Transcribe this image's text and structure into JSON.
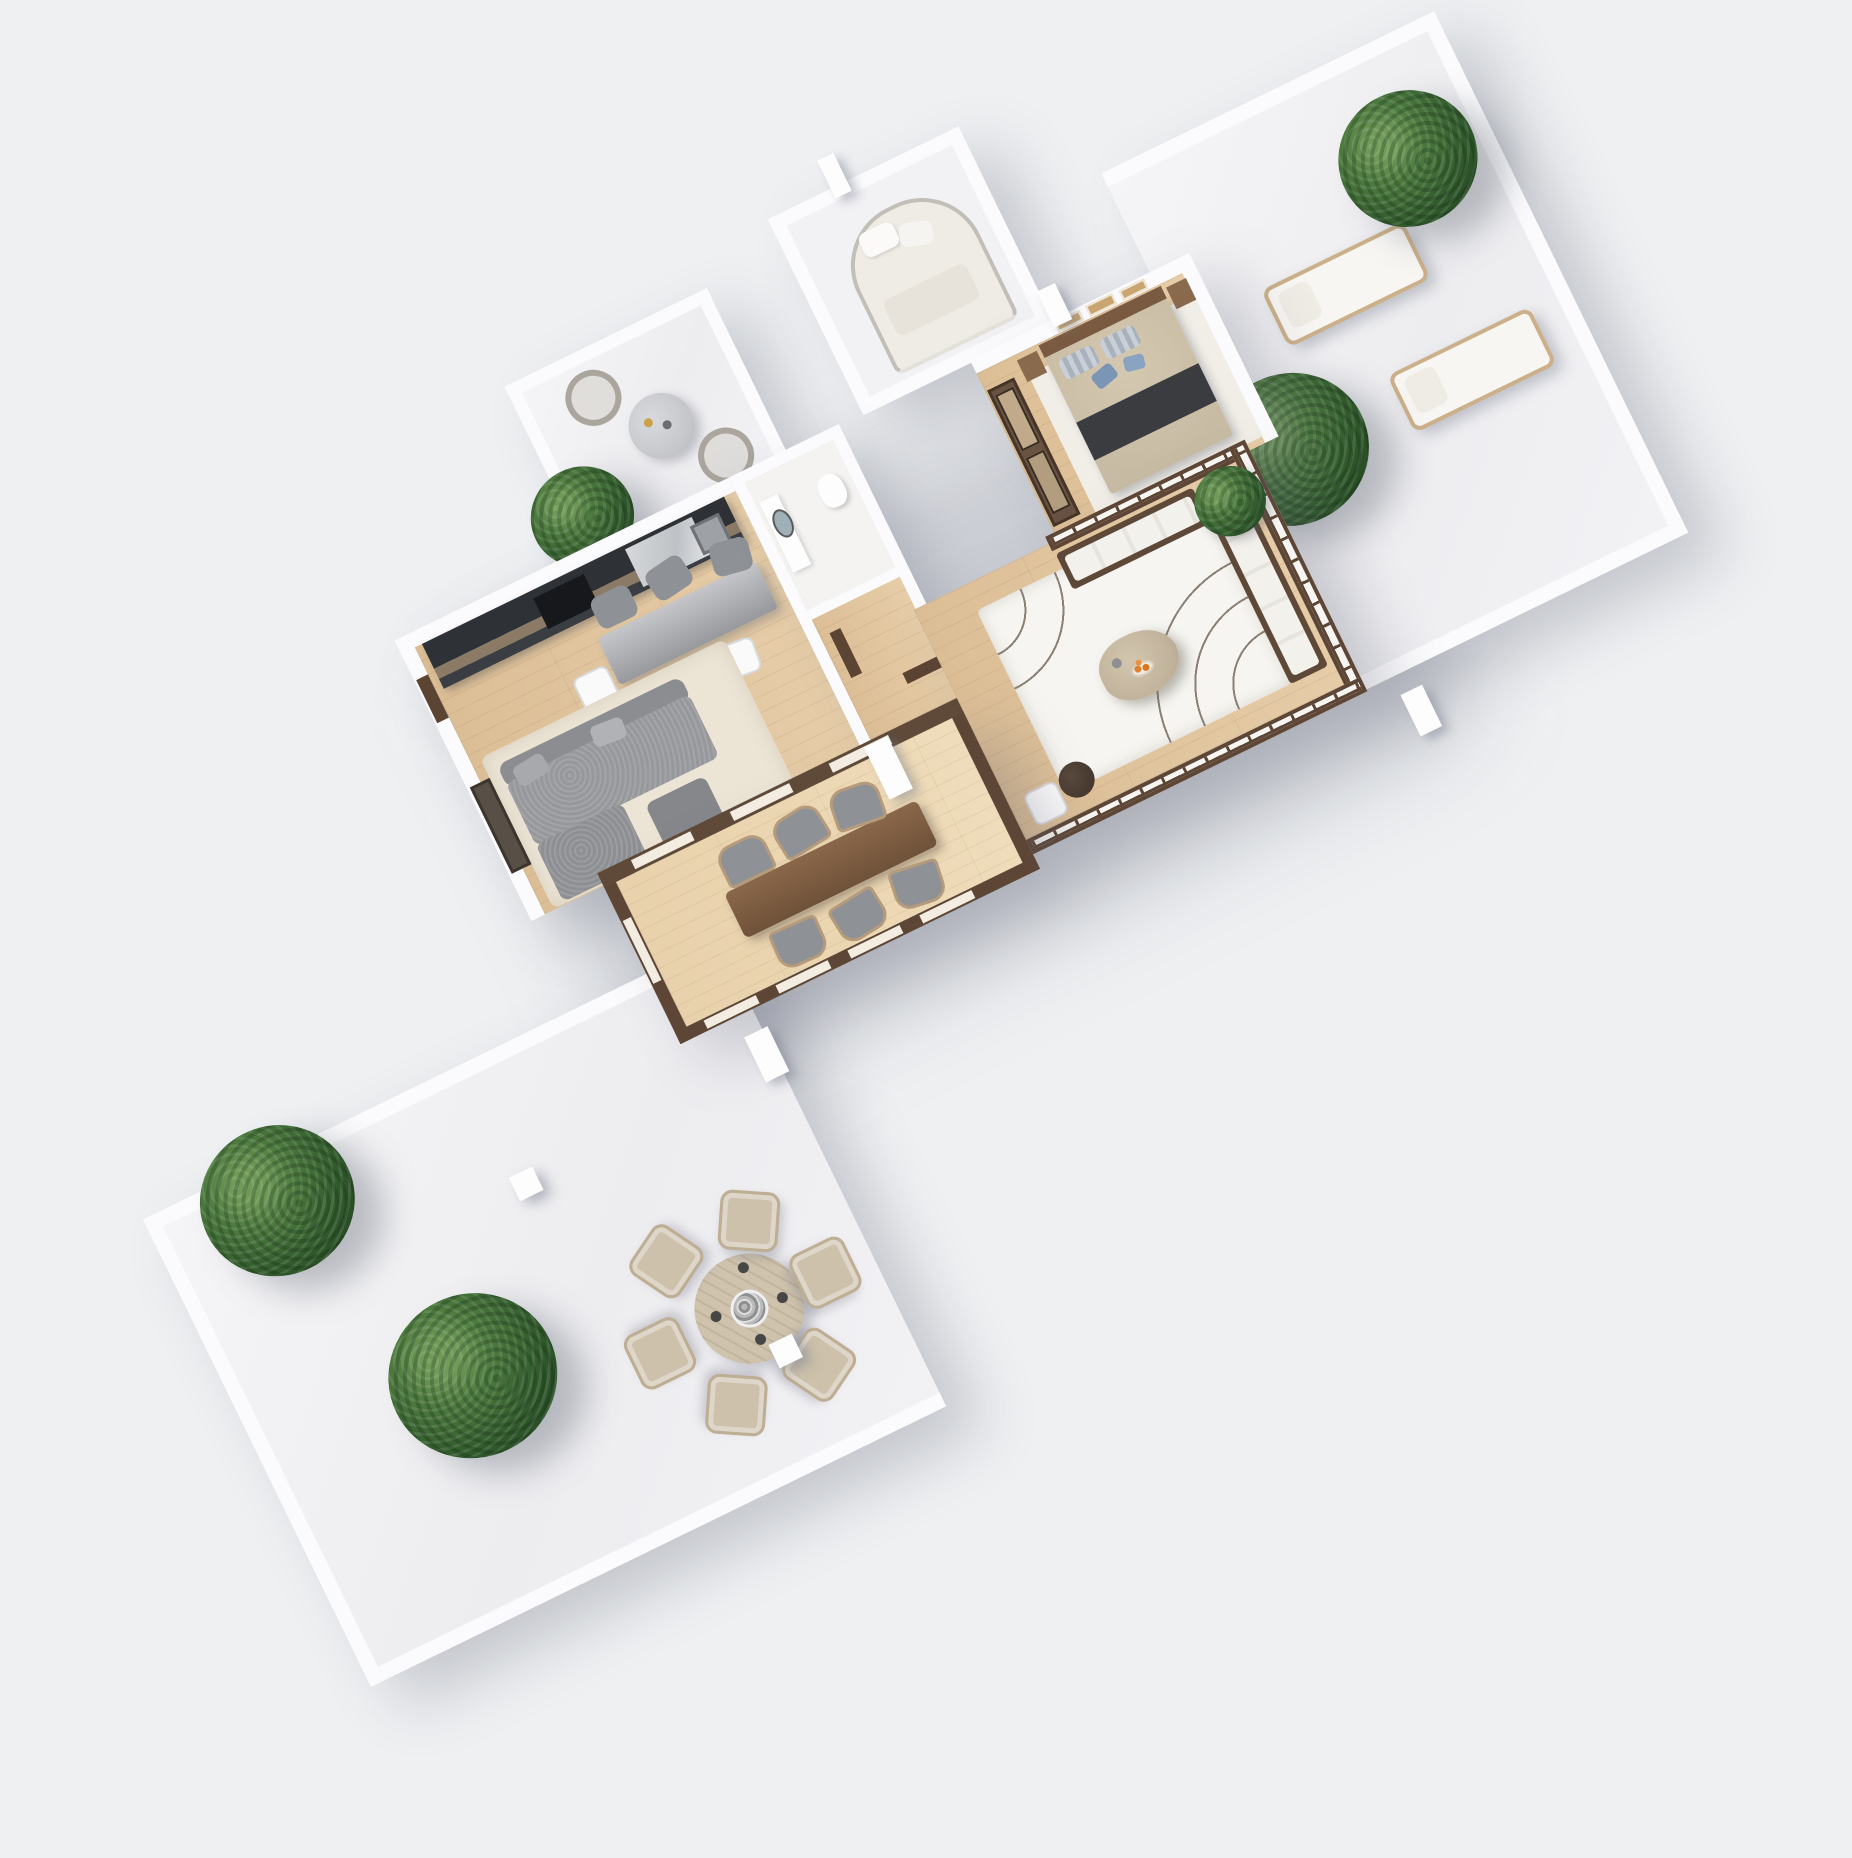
{
  "scene": {
    "type": "3d-floor-plan-render",
    "view": "axonometric top-down apartment visualization, rotated diagonally, no text labels",
    "background_color": "#eef0f2",
    "palette": {
      "bg": "#eef0f2",
      "wall": "#fbfbfd",
      "wood": "#dcbe96",
      "shoji": "#5d4636",
      "dark_wood": "#6a5243",
      "chair_gray": "#8e9195",
      "sofa_gray": "#96989c",
      "rug_cream": "#ece5d6",
      "bed_runner": "#3a3c40",
      "stone": "#c8bba3",
      "accent_orange": "#e08030",
      "leaf_hi": "#6f9a58",
      "leaf_lo": "#254a23"
    },
    "rooms": [
      {
        "name": "entry-room-top",
        "furniture": [
          "white daybed with curved headboard",
          "white walls"
        ]
      },
      {
        "name": "balcony-bistro",
        "furniture": [
          "round marble bistro table",
          "2 wire chairs",
          "potted tree"
        ]
      },
      {
        "name": "kitchen-living-dining",
        "furniture": [
          "dark kitchen counter with marble worktop",
          "steel dining table",
          "3 gray upholstered chairs",
          "3 white chairs",
          "modular gray boucle sofa",
          "cream shag rug",
          "dark media unit"
        ]
      },
      {
        "name": "bathroom",
        "furniture": [
          "vanity counter",
          "round mirror",
          "toilet"
        ]
      },
      {
        "name": "hallway",
        "furniture": [
          "dark wood doors"
        ]
      },
      {
        "name": "master-bedroom",
        "furniture": [
          "double bed with beige duvet and dark runner",
          "striped pillows",
          "blue accent pillows",
          "2 wood nightstands",
          "glass sliding-door wardrobe",
          "3 framed artworks",
          "white rug"
        ]
      },
      {
        "name": "japanese-lounge",
        "furniture": [
          "shoji screen walls",
          "wood-frame sofa with white cushions (right)",
          "wood-frame sofa with white cushions (top)",
          "organic travertine coffee table with fruit plate",
          "arc-pattern rug",
          "round side table",
          "white chair",
          "indoor plant"
        ]
      },
      {
        "name": "veranda-dining",
        "furniture": [
          "long wood dining table",
          "6 curved-back chairs with gray seats",
          "brown mullioned glazing"
        ]
      },
      {
        "name": "terrace-left",
        "furniture": [
          "round slatted outdoor table",
          "6 beige outdoor armchairs",
          "stone centerpiece",
          "2 trees in pots",
          "2 white light cubes"
        ]
      },
      {
        "name": "terrace-right",
        "furniture": [
          "2 white sun loungers with towels",
          "2 trees in pots"
        ]
      }
    ],
    "counts": {
      "trees": 5,
      "terrace_dining_chairs": 6,
      "veranda_chairs": 6,
      "sun_loungers": 2,
      "artworks": 3
    }
  }
}
